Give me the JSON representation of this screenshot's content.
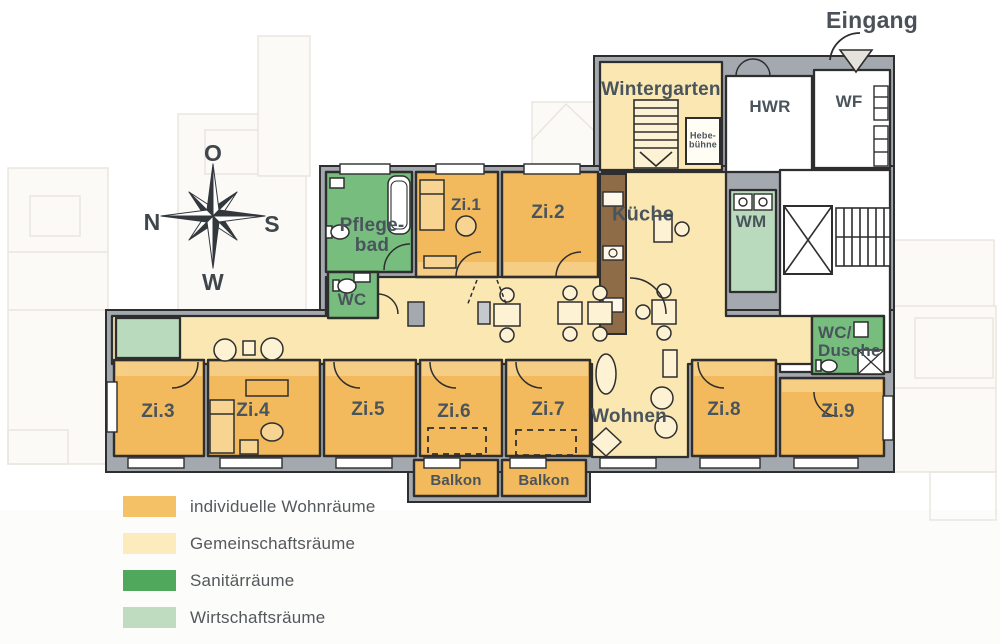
{
  "entrance_label": "Eingang",
  "compass": {
    "up": "O",
    "left": "N",
    "right": "S",
    "down": "W"
  },
  "rooms": {
    "wintergarten": "Wintergarten",
    "hebebuehne": "Hebe-bühne",
    "hwr": "HWR",
    "wf": "WF",
    "kueche": "Küche",
    "wm": "WM",
    "pflegebad": "Pflege-bad",
    "wc": "WC",
    "zi1": "Zi.1",
    "zi2": "Zi.2",
    "zi3": "Zi.3",
    "zi4": "Zi.4",
    "zi5": "Zi.5",
    "zi6": "Zi.6",
    "zi7": "Zi.7",
    "zi8": "Zi.8",
    "zi9": "Zi.9",
    "wohnen": "Wohnen",
    "wc_dusche": "WC/ Dusche",
    "balkon_left": "Balkon",
    "balkon_right": "Balkon"
  },
  "legend": {
    "items": [
      {
        "label": "individuelle Wohnräume",
        "color": "#F4C167"
      },
      {
        "label": "Gemeinschaftsräume",
        "color": "#FCEBBC"
      },
      {
        "label": "Sanitärräume",
        "color": "#4FA85C"
      },
      {
        "label": "Wirtschaftsräume",
        "color": "#BFDCC1"
      }
    ]
  },
  "colors": {
    "individual_rooms": "#F2BA5C",
    "community_rooms": "#FBE7B2",
    "sanitary_rooms": "#77BE7E",
    "utility_rooms": "#B9DABD",
    "wall": "#A3A9AF",
    "outline": "#2E2E2E",
    "label_text": "#4A545C"
  }
}
